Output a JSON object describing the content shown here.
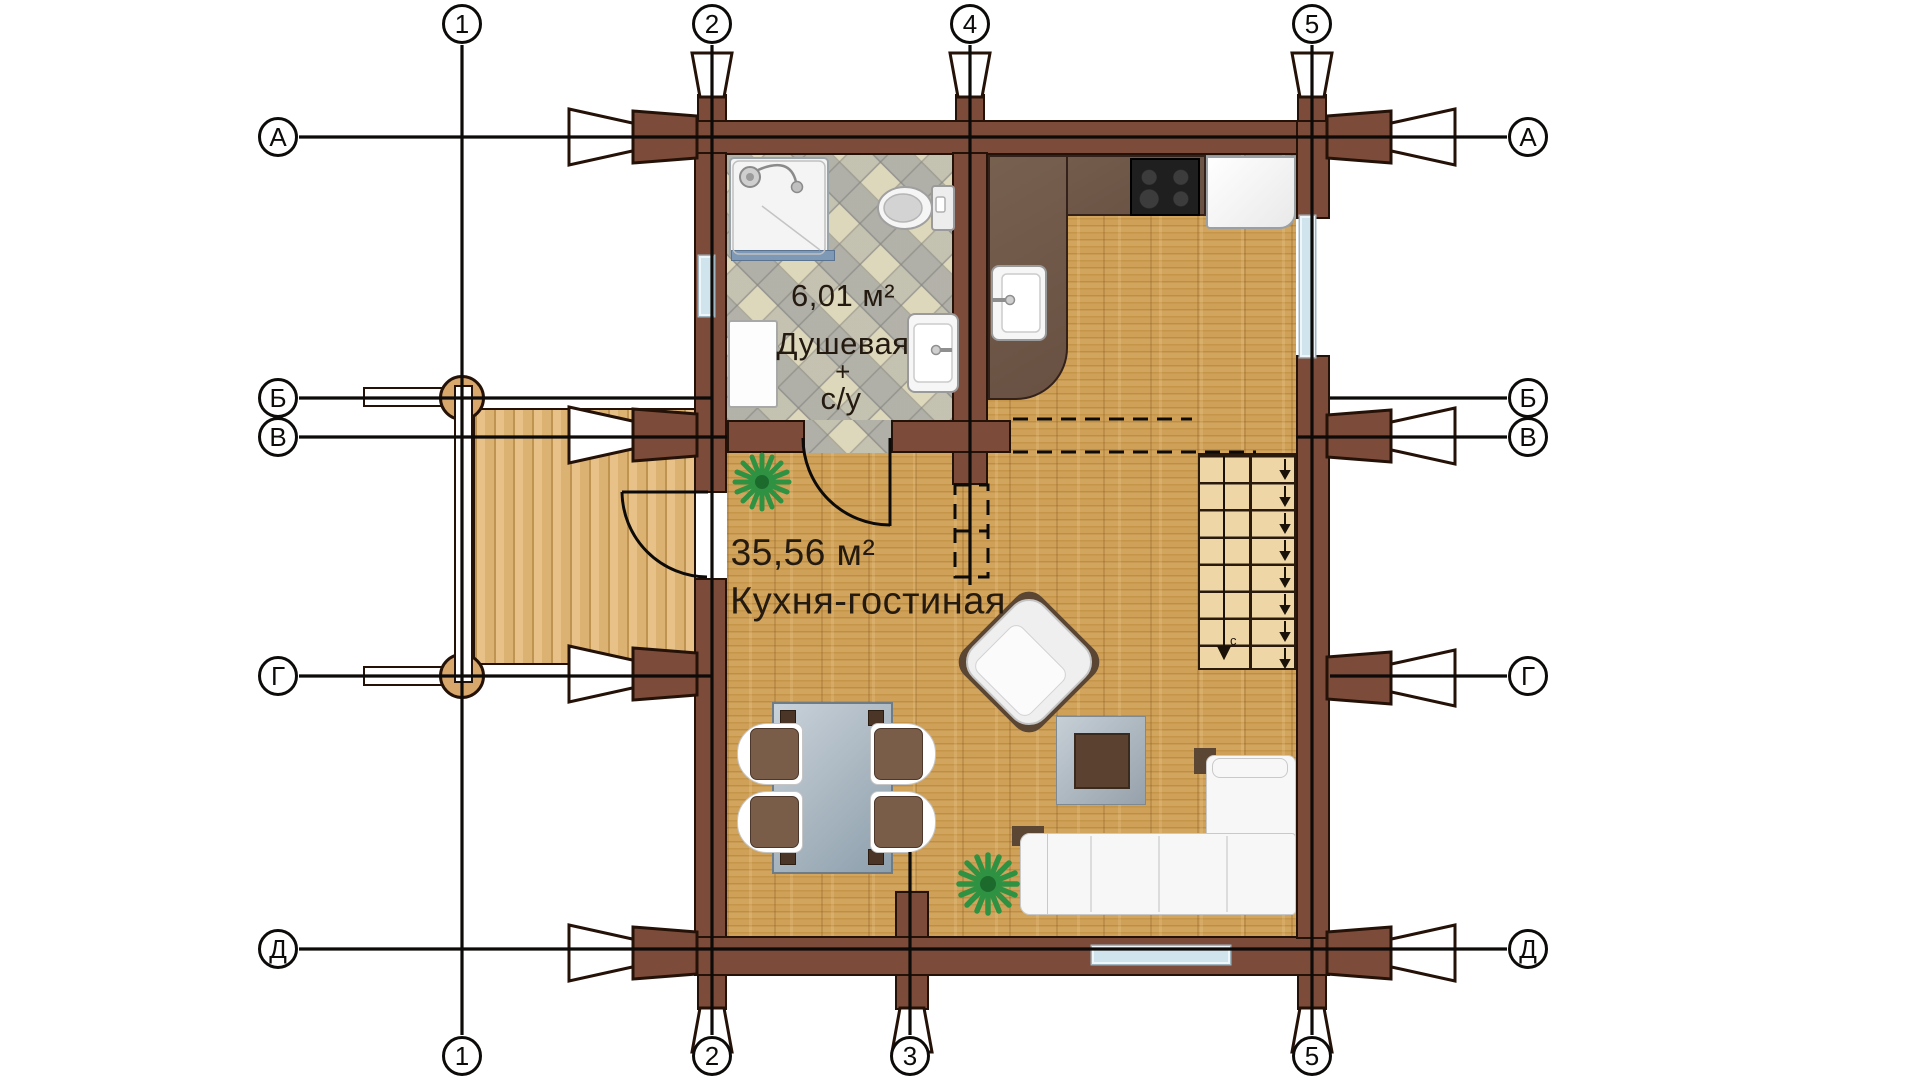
{
  "plan": {
    "rooms": {
      "shower": {
        "area": "6,01 м²",
        "line1": "Душевая",
        "line2": "+",
        "line3": "с/у"
      },
      "kitchen_living": {
        "area": "35,56 м²",
        "name": "Кухня-гостиная"
      }
    },
    "axes": {
      "top": [
        "1",
        "2",
        "4",
        "5"
      ],
      "bottom": [
        "1",
        "2",
        "3",
        "5"
      ],
      "left": [
        "А",
        "Б",
        "В",
        "Г",
        "Д"
      ],
      "right": [
        "А",
        "Б",
        "В",
        "Г",
        "Д"
      ]
    },
    "stairs": {
      "down_label": "с"
    },
    "colors": {
      "wall": "#7d4b39",
      "outline": "#241107",
      "wood_floor": "#cda05c",
      "terrace_floor": "#e3bc80",
      "tile_beige": "#d9d3b8",
      "tile_gray": "#b7b7b1",
      "window": "#cfe4ec",
      "counter": "#6f5849",
      "stair_tread": "#efd6a6",
      "glass_table": "#b5c0c9",
      "text": "#241a10",
      "plant": "#2f9242"
    }
  }
}
